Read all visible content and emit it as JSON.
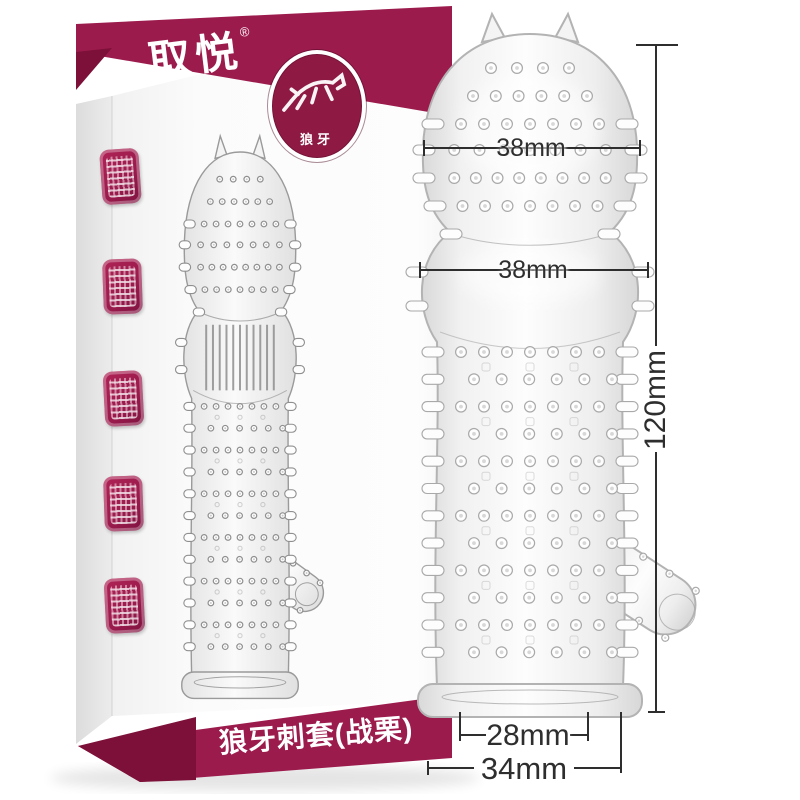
{
  "box": {
    "brand_logo": "取悦",
    "registered_mark": "®",
    "badge": {
      "label": "狼牙"
    },
    "product_name": "狼牙刺套(战栗)"
  },
  "measurements": {
    "head_width": "38mm",
    "ball_width": "38mm",
    "total_length": "120mm",
    "base_inner_width": "28mm",
    "base_outer_width": "34mm"
  },
  "colors": {
    "brand_magenta": "#9c1b4d",
    "brand_magenta_dark": "#7c1038",
    "badge_fill": "#8e1a44",
    "dimension_ink": "#2e2e2e"
  }
}
